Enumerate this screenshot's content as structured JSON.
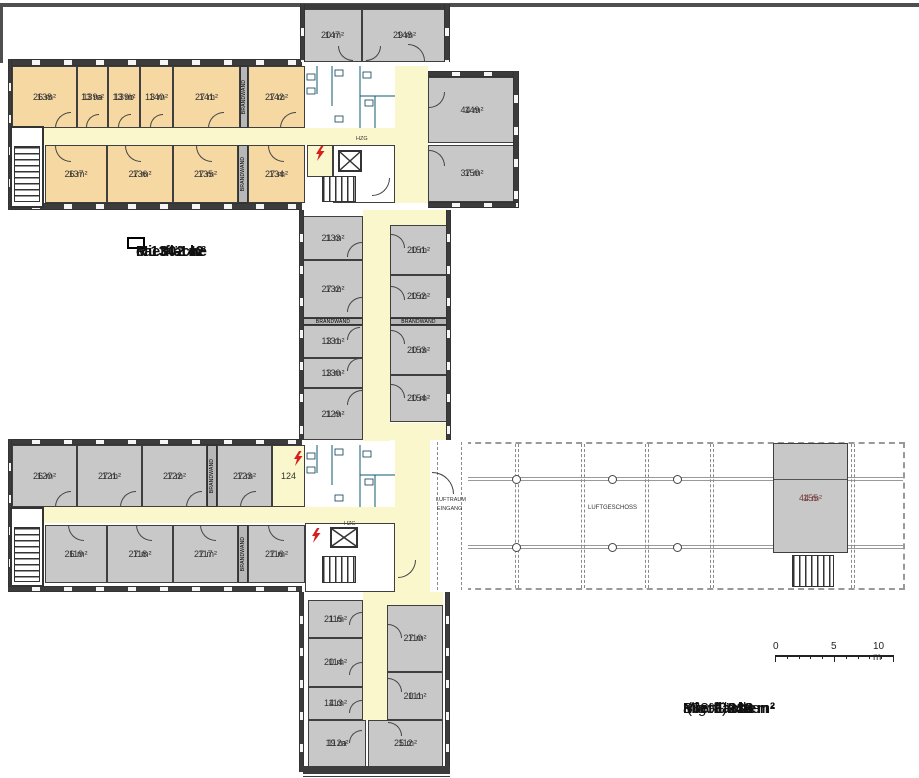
{
  "plan": {
    "colors": {
      "office_orange": "#f6d8a3",
      "room_gray": "#c8c8c8",
      "corridor_yellow": "#f9f7cb",
      "sanitary_cyan": "#2fc4e4",
      "wall_dark": "#3c3c3c",
      "flash_red": "#d42020",
      "room155_label": "#7a4040"
    },
    "rooms": [
      {
        "number": "147",
        "area": "20 m²",
        "x": 303,
        "y": 9,
        "w": 59,
        "h": 53,
        "fill": "gray"
      },
      {
        "number": "148",
        "area": "29 m²",
        "x": 362,
        "y": 9,
        "w": 85,
        "h": 53,
        "fill": "gray"
      },
      {
        "number": "138",
        "area": "26 m²",
        "x": 12,
        "y": 66,
        "w": 65,
        "h": 62,
        "fill": "orange"
      },
      {
        "number": "139a",
        "area": "13 m²",
        "x": 77,
        "y": 66,
        "w": 31,
        "h": 62,
        "fill": "orange"
      },
      {
        "number": "139b",
        "area": "13 m²",
        "x": 108,
        "y": 66,
        "w": 32,
        "h": 62,
        "fill": "orange"
      },
      {
        "number": "140",
        "area": "13 m²",
        "x": 140,
        "y": 66,
        "w": 33,
        "h": 62,
        "fill": "orange"
      },
      {
        "number": "141",
        "area": "27 m²",
        "x": 173,
        "y": 66,
        "w": 67,
        "h": 62,
        "fill": "orange"
      },
      {
        "number": "142",
        "area": "27 m²",
        "x": 248,
        "y": 66,
        "w": 57,
        "h": 62,
        "fill": "orange"
      },
      {
        "number": "137",
        "area": "26 m²",
        "x": 45,
        "y": 145,
        "w": 62,
        "h": 58,
        "fill": "orange"
      },
      {
        "number": "136",
        "area": "27 m²",
        "x": 107,
        "y": 145,
        "w": 66,
        "h": 58,
        "fill": "orange"
      },
      {
        "number": "135",
        "area": "27 m²",
        "x": 173,
        "y": 145,
        "w": 65,
        "h": 58,
        "fill": "orange"
      },
      {
        "number": "134",
        "area": "27 m²",
        "x": 248,
        "y": 145,
        "w": 57,
        "h": 58,
        "fill": "orange"
      },
      {
        "number": "149",
        "area": "44 m²",
        "x": 428,
        "y": 77,
        "w": 88,
        "h": 66,
        "fill": "gray"
      },
      {
        "number": "150",
        "area": "37 m²",
        "x": 428,
        "y": 145,
        "w": 88,
        "h": 57,
        "fill": "gray"
      },
      {
        "number": "133",
        "area": "21 m²",
        "x": 303,
        "y": 216,
        "w": 60,
        "h": 44,
        "fill": "gray"
      },
      {
        "number": "132",
        "area": "27 m²",
        "x": 303,
        "y": 260,
        "w": 60,
        "h": 58,
        "fill": "gray"
      },
      {
        "number": "131",
        "area": "13 m²",
        "x": 303,
        "y": 325,
        "w": 60,
        "h": 33,
        "fill": "gray"
      },
      {
        "number": "130",
        "area": "13 m²",
        "x": 303,
        "y": 358,
        "w": 60,
        "h": 30,
        "fill": "gray"
      },
      {
        "number": "129",
        "area": "21 m²",
        "x": 303,
        "y": 388,
        "w": 60,
        "h": 52,
        "fill": "gray"
      },
      {
        "number": "151",
        "area": "20 m²",
        "x": 390,
        "y": 225,
        "w": 57,
        "h": 50,
        "fill": "gray"
      },
      {
        "number": "152",
        "area": "20 m²",
        "x": 390,
        "y": 275,
        "w": 57,
        "h": 43,
        "fill": "gray"
      },
      {
        "number": "153",
        "area": "20 m²",
        "x": 390,
        "y": 325,
        "w": 57,
        "h": 50,
        "fill": "gray"
      },
      {
        "number": "154",
        "area": "20 m²",
        "x": 390,
        "y": 375,
        "w": 57,
        "h": 47,
        "fill": "gray"
      },
      {
        "number": "120",
        "area": "26 m²",
        "x": 12,
        "y": 445,
        "w": 65,
        "h": 62,
        "fill": "gray"
      },
      {
        "number": "121",
        "area": "27 m²",
        "x": 77,
        "y": 445,
        "w": 65,
        "h": 62,
        "fill": "gray"
      },
      {
        "number": "122",
        "area": "27 m²",
        "x": 142,
        "y": 445,
        "w": 65,
        "h": 62,
        "fill": "gray"
      },
      {
        "number": "123",
        "area": "27 m²",
        "x": 217,
        "y": 445,
        "w": 55,
        "h": 62,
        "fill": "gray"
      },
      {
        "number": "124",
        "area": "",
        "x": 272,
        "y": 445,
        "w": 33,
        "h": 62,
        "fill": "yellowroom"
      },
      {
        "number": "119",
        "area": "26 m²",
        "x": 45,
        "y": 525,
        "w": 62,
        "h": 58,
        "fill": "gray"
      },
      {
        "number": "118",
        "area": "27 m²",
        "x": 107,
        "y": 525,
        "w": 66,
        "h": 58,
        "fill": "gray"
      },
      {
        "number": "117",
        "area": "27 m²",
        "x": 173,
        "y": 525,
        "w": 65,
        "h": 58,
        "fill": "gray"
      },
      {
        "number": "116",
        "area": "27 m²",
        "x": 248,
        "y": 525,
        "w": 57,
        "h": 58,
        "fill": "gray"
      },
      {
        "number": "155",
        "area": "44 m²",
        "x": 773,
        "y": 443,
        "w": 75,
        "h": 110,
        "fill": "gray",
        "special": "r155"
      },
      {
        "number": "115",
        "area": "21 m²",
        "x": 308,
        "y": 600,
        "w": 55,
        "h": 38,
        "fill": "gray"
      },
      {
        "number": "114",
        "area": "20 m²",
        "x": 308,
        "y": 638,
        "w": 55,
        "h": 49,
        "fill": "gray"
      },
      {
        "number": "113",
        "area": "14 m²",
        "x": 308,
        "y": 687,
        "w": 55,
        "h": 33,
        "fill": "gray"
      },
      {
        "number": "112a",
        "area": "19 m²",
        "x": 308,
        "y": 720,
        "w": 58,
        "h": 47,
        "fill": "gray"
      },
      {
        "number": "110",
        "area": "27 m²",
        "x": 387,
        "y": 605,
        "w": 56,
        "h": 67,
        "fill": "gray"
      },
      {
        "number": "111",
        "area": "20 m²",
        "x": 387,
        "y": 672,
        "w": 56,
        "h": 48,
        "fill": "gray"
      },
      {
        "number": "112",
        "area": "25 m²",
        "x": 368,
        "y": 720,
        "w": 75,
        "h": 47,
        "fill": "gray"
      }
    ],
    "firewalls": [
      {
        "label": "BRANDWAND",
        "x": 240,
        "y": 66,
        "w": 8,
        "h": 62,
        "vert": true
      },
      {
        "label": "BRANDWAND",
        "x": 238,
        "y": 145,
        "w": 10,
        "h": 58,
        "vert": true
      },
      {
        "label": "BRANDWAND",
        "x": 303,
        "y": 318,
        "w": 60,
        "h": 7,
        "vert": false
      },
      {
        "label": "BRANDWAND",
        "x": 390,
        "y": 318,
        "w": 57,
        "h": 7,
        "vert": false
      },
      {
        "label": "BRANDWAND",
        "x": 207,
        "y": 445,
        "w": 10,
        "h": 62,
        "vert": true
      },
      {
        "label": "BRANDWAND",
        "x": 238,
        "y": 525,
        "w": 10,
        "h": 58,
        "vert": true
      }
    ],
    "small_labels": [
      {
        "id": "hzg-top",
        "text": "HZG",
        "x": 356,
        "y": 136,
        "size": 5.5
      },
      {
        "id": "hzg-bottom",
        "text": "HZG",
        "x": 344,
        "y": 521,
        "size": 5.5
      },
      {
        "id": "luftraum",
        "text": "LUFTRAUM",
        "x": 436,
        "y": 497,
        "size": 5.5
      },
      {
        "id": "eingang",
        "text": "EINGANG",
        "x": 437,
        "y": 506,
        "size": 5.5
      },
      {
        "id": "luftgeschoss",
        "text": "LUFTGESCHOSS",
        "x": 588,
        "y": 505,
        "size": 6
      }
    ],
    "callout": {
      "lines": [
        "R 134-142",
        "Mietfläche",
        "ca. 302 m²"
      ]
    },
    "scale_bar": {
      "labels": [
        "0",
        "5",
        "10 m"
      ]
    },
    "totals": {
      "rows": [
        {
          "label": "Bürofläche",
          "value": "936 m²",
          "suffix": "",
          "bold": false
        },
        {
          "label": "allg. Flächen",
          "value": "312 m²",
          "suffix": "(33%)",
          "bold": false
        },
        {
          "label": "Mietfläche",
          "value": "1.248 m²",
          "suffix": "",
          "bold": true
        }
      ]
    }
  }
}
